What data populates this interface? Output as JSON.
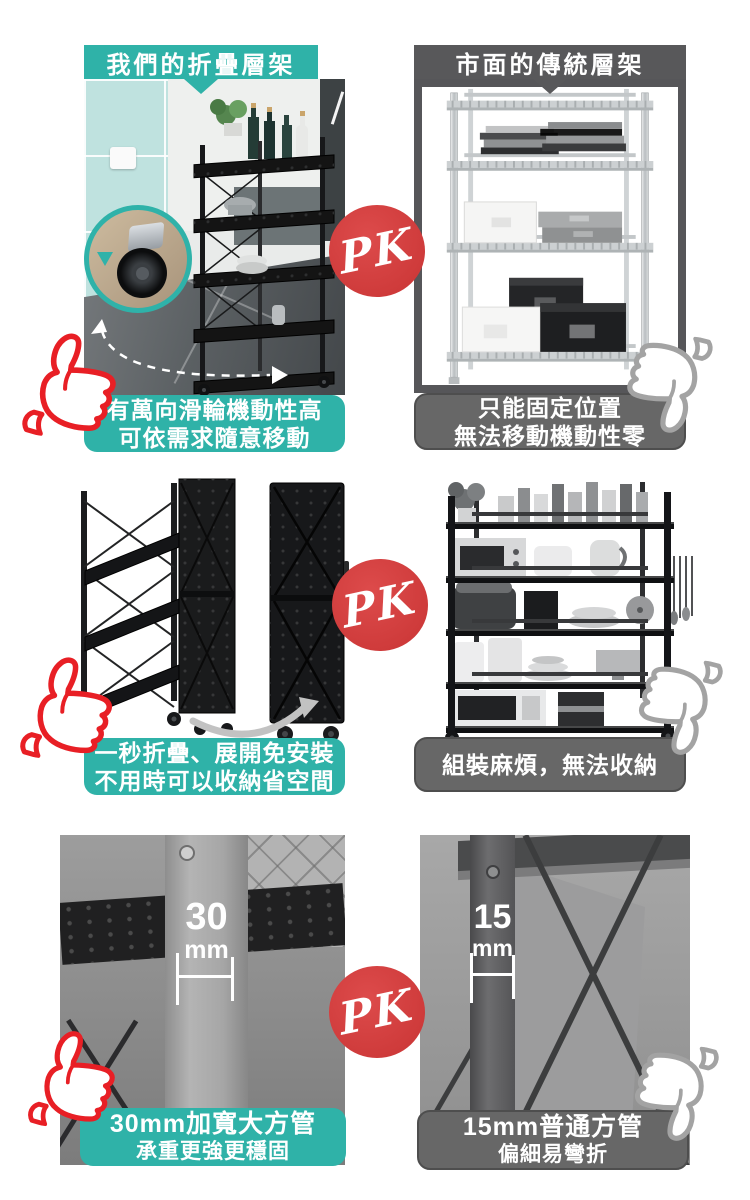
{
  "pk_label": "PK",
  "colors": {
    "teal": "#2fb2a8",
    "header_gray": "#58585a",
    "caption_gray": "#676767",
    "pk_red": "#ce3a3a",
    "thumb_red": "#e81f25",
    "thumb_gray": "#a3a3a3"
  },
  "icons": {
    "positive_verdict": "thumbs-up-icon",
    "negative_verdict": "thumbs-down-icon"
  },
  "sections": [
    {
      "id": "mobility",
      "left": {
        "header": "我們的折疊層架",
        "caption": [
          "有萬向滑輪機動性高",
          "可依需求隨意移動"
        ],
        "verdict": "thumbs-up"
      },
      "right": {
        "header": "市面的傳統層架",
        "caption": [
          "只能固定位置",
          "無法移動機動性零"
        ],
        "verdict": "thumbs-down"
      }
    },
    {
      "id": "foldability",
      "left": {
        "caption": [
          "一秒折疊、展開免安裝",
          "不用時可以收納省空間"
        ],
        "verdict": "thumbs-up"
      },
      "right": {
        "caption": [
          "組裝麻煩，無法收納"
        ],
        "verdict": "thumbs-down"
      }
    },
    {
      "id": "tube-size",
      "left": {
        "measurement": {
          "value": "30",
          "unit": "mm"
        },
        "caption": [
          "30mm加寬大方管",
          "承重更強更穩固"
        ],
        "verdict": "thumbs-up"
      },
      "right": {
        "measurement": {
          "value": "15",
          "unit": "mm"
        },
        "caption": [
          "15mm普通方管",
          "偏細易彎折"
        ],
        "verdict": "thumbs-down"
      }
    }
  ]
}
